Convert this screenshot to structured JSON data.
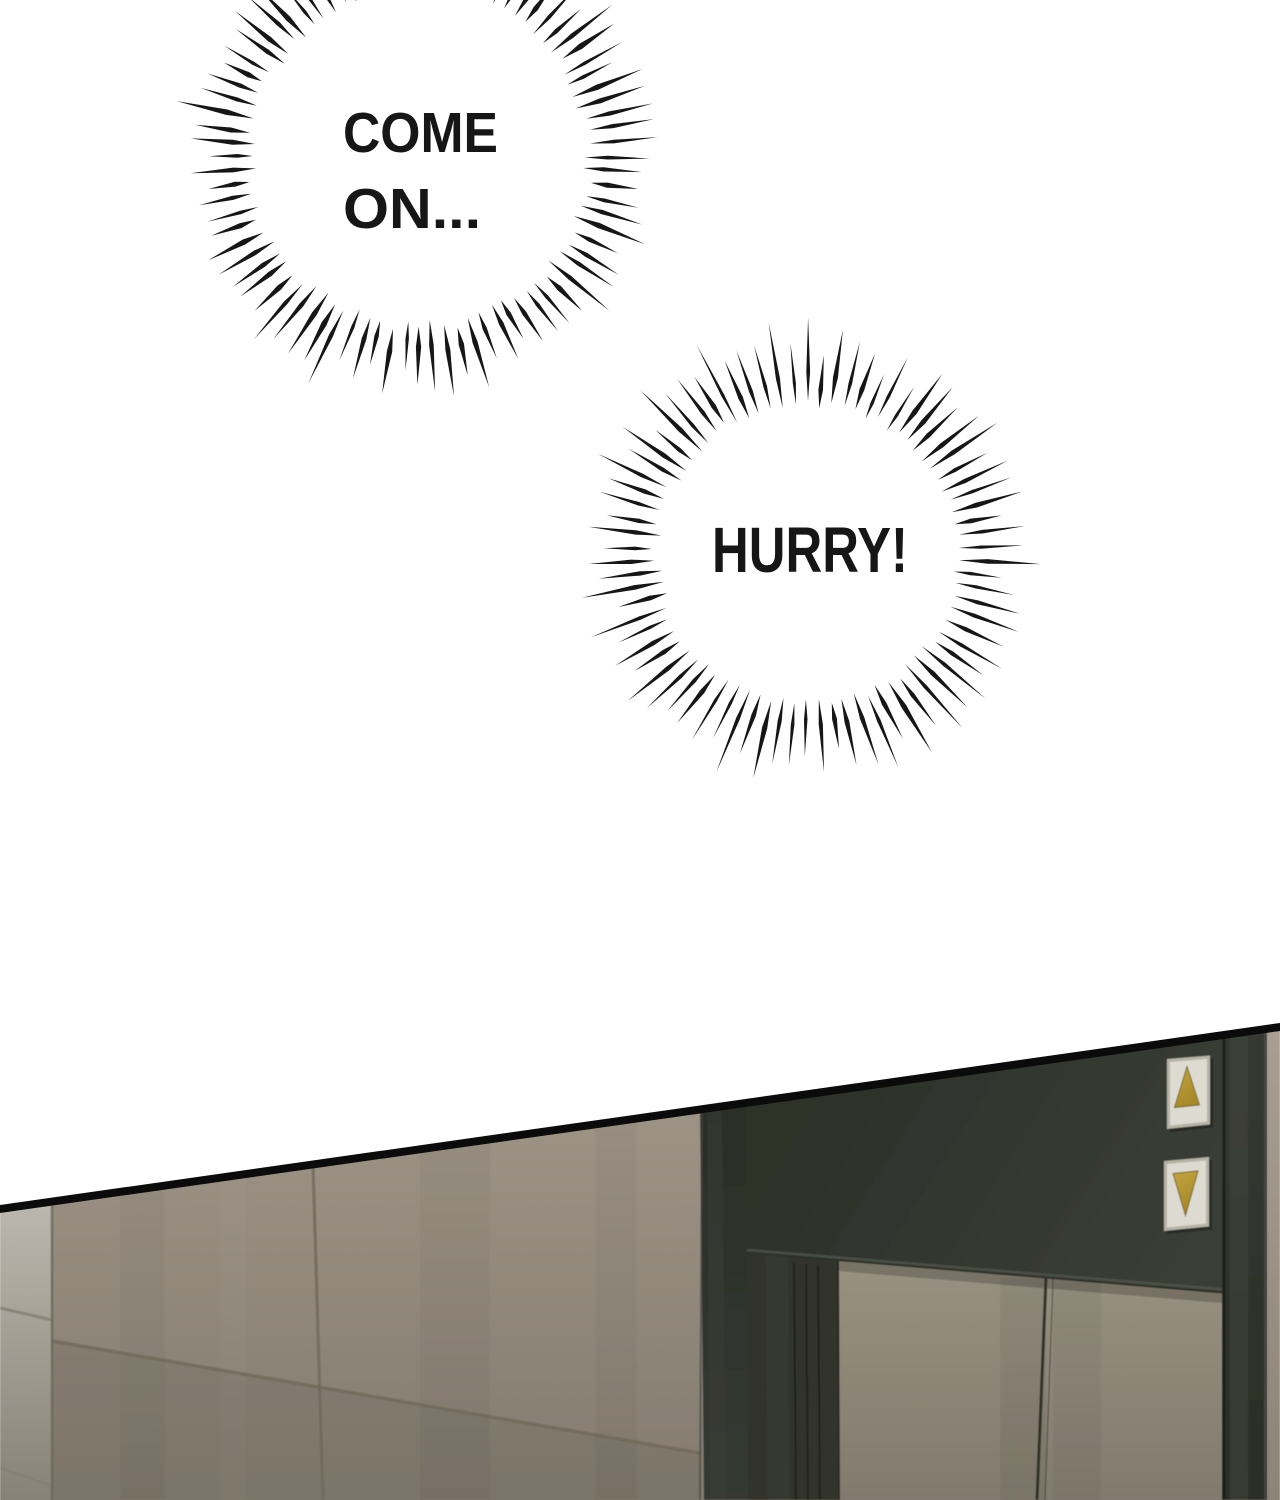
{
  "panel": {
    "background": "#ffffff"
  },
  "speech_bubbles": [
    {
      "name": "come-on",
      "lines": [
        "COME",
        "ON..."
      ]
    },
    {
      "name": "hurry",
      "lines": [
        "HURRY!"
      ]
    }
  ],
  "scene": {
    "elevator": {
      "call_buttons": [
        {
          "direction": "up"
        },
        {
          "direction": "down"
        }
      ]
    }
  },
  "colors": {
    "ink": "#161616",
    "border": "#0b0b0b",
    "wall_tile_light": "#aba192",
    "wall_tile_dark": "#8c8376",
    "wall_side_light": "#c8c3b9",
    "wall_side_dark": "#8f8a7f",
    "tile_gap": "#77705f",
    "frame_dark": "#2d312a",
    "frame_mid": "#3a3e36",
    "header_top": "#30342c",
    "header_bottom": "#3e433a",
    "header_lip": "#565b50",
    "door_light": "#a19988",
    "door_dark": "#8a8274",
    "door_seam": "#33362c",
    "sliver_light": "#b2a99b",
    "sliver_dark": "#948c7e",
    "button_plate": "#eae7de",
    "button_plate_edge": "#c2beb1",
    "arrow_gold_light": "#d0b047",
    "arrow_gold_dark": "#a98b24",
    "arrow_outline": "#7c681a"
  }
}
